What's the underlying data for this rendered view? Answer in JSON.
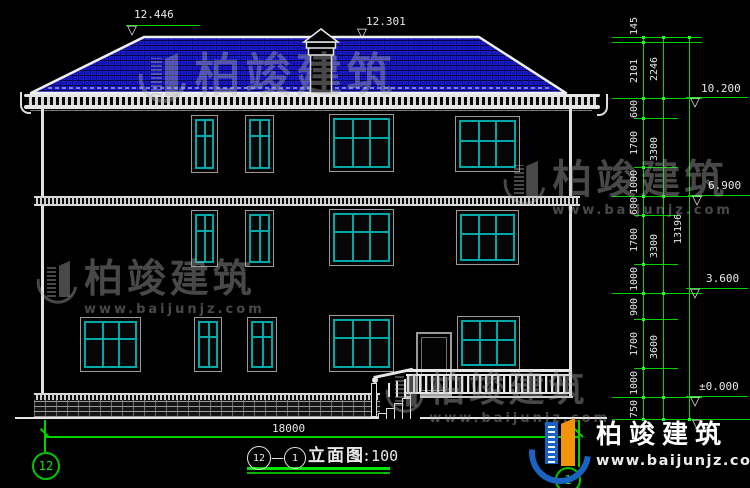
{
  "drawing": {
    "title": {
      "axis_a": "12",
      "sep": "—",
      "axis_b": "1",
      "name": "立面图",
      "scale": "1:100"
    },
    "elevations": {
      "ridge_left": "12.446",
      "ridge_right": "12.301",
      "eave": "10.200",
      "floor3": "6.900",
      "floor2": "3.600",
      "ground": "±0.000"
    },
    "dimensions": {
      "inner": [
        "145",
        "2101",
        "600",
        "1700",
        "1000",
        "600",
        "1700",
        "1000",
        "900",
        "1700",
        "1000",
        "750"
      ],
      "middle": [
        "2246",
        "3300",
        "3300",
        "3600"
      ],
      "total": "13196",
      "width": "18000"
    },
    "axes": {
      "left": "12",
      "right": "1"
    }
  },
  "watermark": {
    "brand": "柏竣建筑",
    "url": "www.baijunjz.com"
  },
  "logo": {
    "brand": "柏竣建筑",
    "url": "www.baijunjz.com"
  },
  "colors": {
    "dim_green": "#00d400",
    "window_teal": "#00a8a8",
    "roof_blue": "#1c1ccf"
  }
}
